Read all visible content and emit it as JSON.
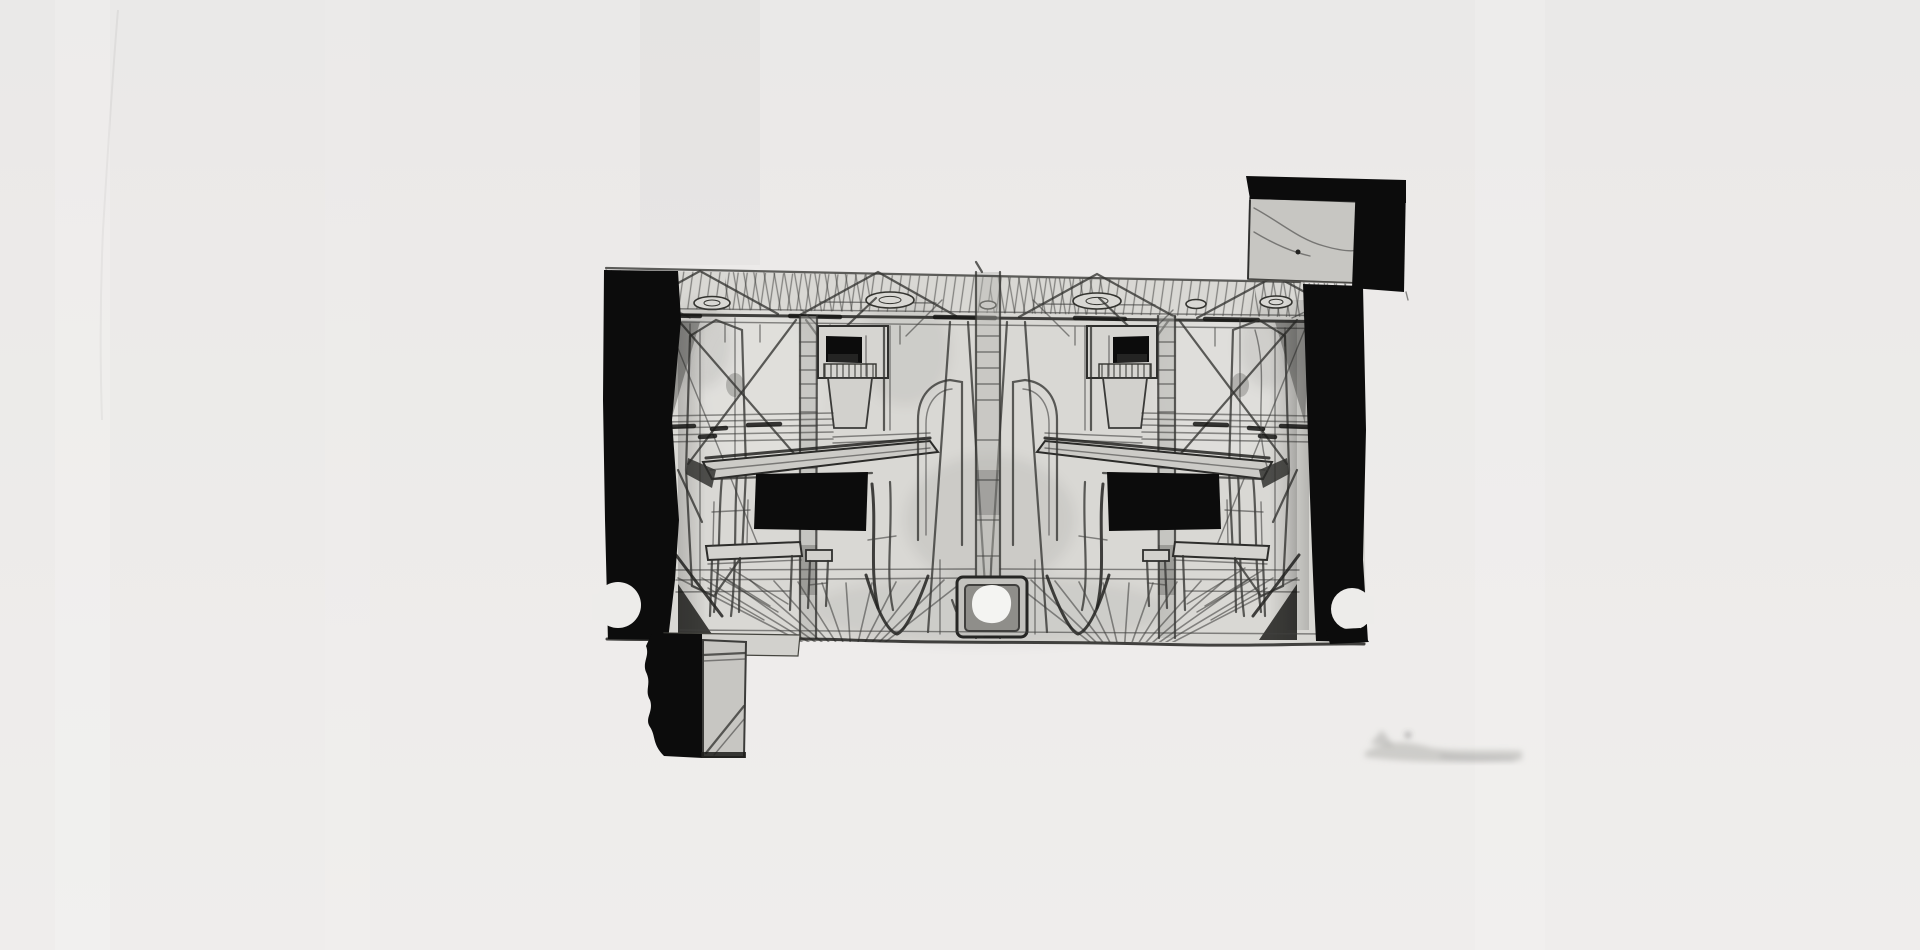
{
  "canvas": {
    "width": 1920,
    "height": 950
  },
  "colors": {
    "background": "#edecea",
    "paper": "#d9d8d4",
    "ink_black": "#0c0c0c",
    "pencil_dark": "#2e2e2e",
    "pencil_mid": "#4a4a48",
    "panel_gray": "#c7c6c2",
    "hole_white": "#f4f4f2"
  },
  "artwork": {
    "type": "monochrome-etching-print",
    "subject": "twin mirrored room interiors",
    "features": [
      "ceiling-rafters",
      "roof-trusses",
      "ceiling-rosettes",
      "wall-window",
      "desk-with-dark-kneehole",
      "bench",
      "stool",
      "floorboards",
      "center-fold-post",
      "floor-plate-white-hole",
      "left-ink-border",
      "right-ink-border",
      "border-notches",
      "chimney-block",
      "foot-block",
      "paper-smudges"
    ]
  }
}
